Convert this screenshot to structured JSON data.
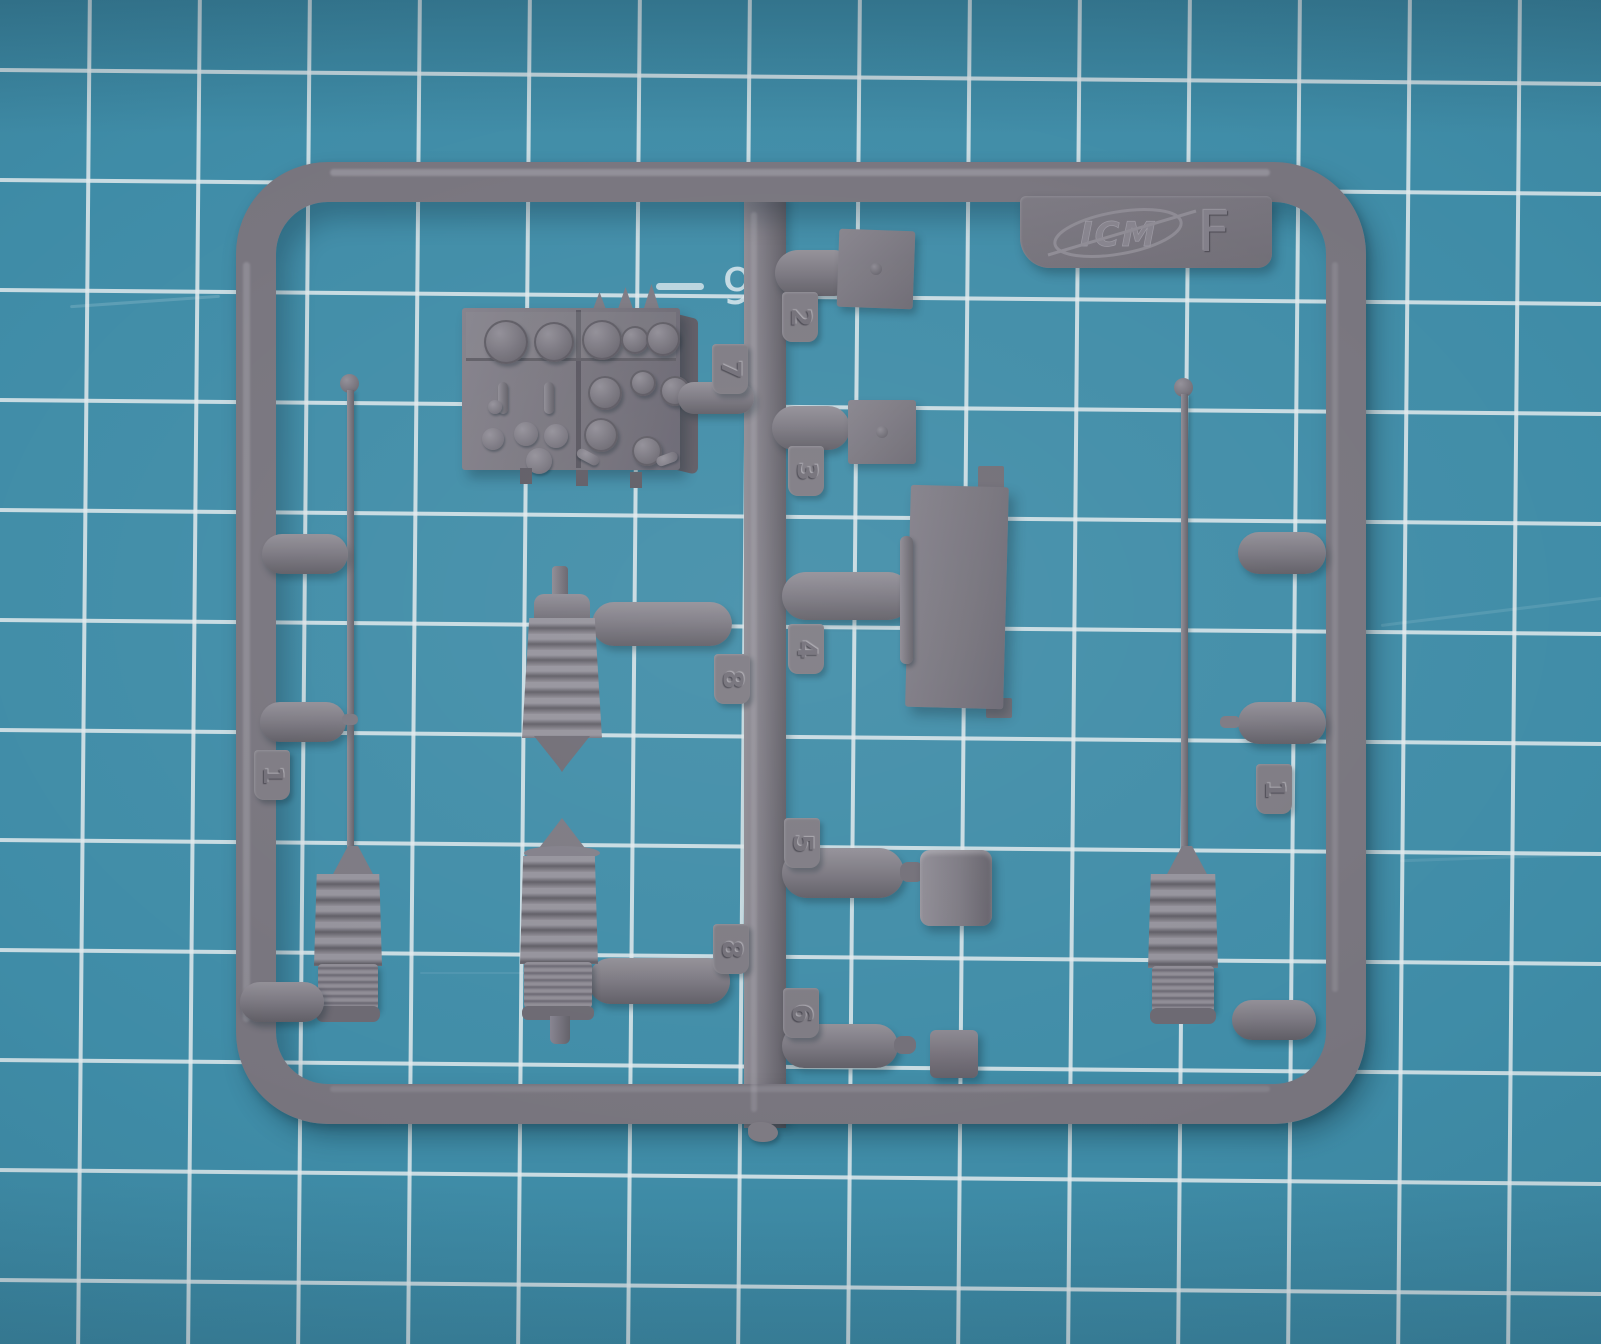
{
  "scene": {
    "description": "Photograph of a grey plastic model-kit sprue (runner F by ICM) lying on a teal cutting mat with white grid lines"
  },
  "brand_plate": {
    "brand": "ICM",
    "sprue_letter": "F"
  },
  "mat": {
    "printed_digit": "9",
    "surface_color": "#3F8CA7",
    "grid_line_color": "#E0E9EC"
  },
  "sprue": {
    "plastic_color": "#77747D",
    "part_tabs": [
      {
        "label": "2"
      },
      {
        "label": "7"
      },
      {
        "label": "3"
      },
      {
        "label": "4"
      },
      {
        "label": "8"
      },
      {
        "label": "5"
      },
      {
        "label": "8"
      },
      {
        "label": "6"
      },
      {
        "label": "1"
      },
      {
        "label": "1"
      }
    ],
    "parts": [
      "instrument-panel-box",
      "small-square-plate-with-boss",
      "small-square-plate-with-boss",
      "hatch-panel-with-rib",
      "cylinder-with-drum-head",
      "cylinder-with-cube-head",
      "bellows-spring-cover",
      "bellows-spring-cover",
      "whip-antenna-with-spring-base",
      "whip-antenna-with-spring-base"
    ]
  }
}
